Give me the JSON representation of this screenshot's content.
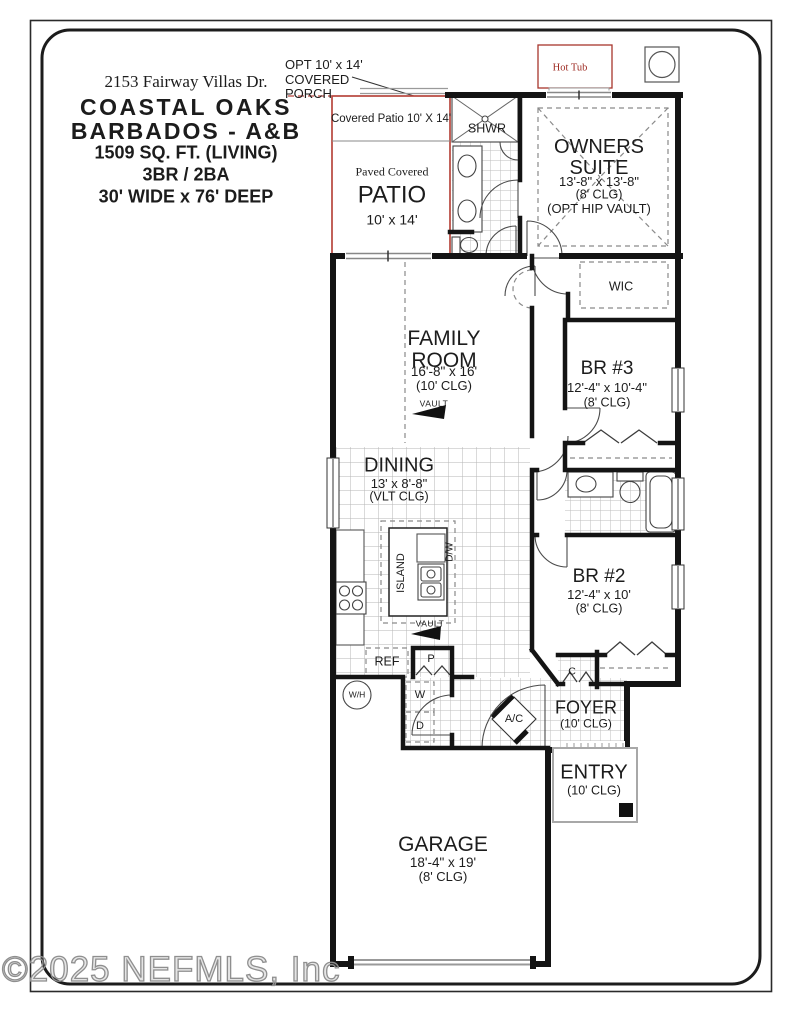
{
  "header": {
    "address": "2153 Fairway Villas Dr.",
    "plan_line1": "COASTAL OAKS",
    "plan_line2": "BARBADOS - A&B",
    "sqft": "1509 SQ. FT. (LIVING)",
    "beds_baths": "3BR  / 2BA",
    "size": "30' WIDE x 76' DEEP"
  },
  "annotations": {
    "opt_porch": "OPT 10' x 14'\nCOVERED\nPORCH",
    "hot_tub": "Hot Tub",
    "watermark": "©2025 NEFMLS, Inc"
  },
  "rooms": {
    "patio": {
      "covered_label": "Covered Patio 10' X 14'",
      "pretitle": "Paved Covered",
      "name": "PATIO",
      "dims": "10' x  14'"
    },
    "owners_suite": {
      "name": "OWNERS\nSUITE",
      "dims": "13'-8\" x  13'-8\"",
      "clg": "(8' CLG)",
      "opt": "(OPT HIP VAULT)"
    },
    "wic": {
      "name": "WIC"
    },
    "family": {
      "name": "FAMILY\nROOM",
      "dims": "16'-8\" x  16'",
      "clg": "(10' CLG)",
      "vault": "VAULT"
    },
    "br3": {
      "name": "BR #3",
      "dims": "12'-4\" x  10'-4\"",
      "clg": "(8' CLG)"
    },
    "dining": {
      "name": "DINING",
      "dims": "13' x  8'-8\"",
      "clg": "(VLT CLG)"
    },
    "br2": {
      "name": "BR #2",
      "dims": "12'-4\" x  10'",
      "clg": "(8' CLG)"
    },
    "foyer": {
      "name": "FOYER",
      "clg": "(10' CLG)"
    },
    "entry": {
      "name": "ENTRY",
      "clg": "(10' CLG)"
    },
    "garage": {
      "name": "GARAGE",
      "dims": "18'-4\" x  19'",
      "clg": "(8' CLG)"
    }
  },
  "fixtures": {
    "shower": "SHWR",
    "island": "ISLAND",
    "dishwasher": "D/W",
    "vault_kitchen": "VAULT",
    "refrigerator": "REF",
    "pantry": "P",
    "water_heater": "W/H",
    "washer": "W",
    "dryer": "D",
    "ac": "A/C",
    "closet": "C"
  },
  "colors": {
    "accent_red": "#b8463e",
    "dark_red": "#9e2b23",
    "wall": "#141414",
    "tile_line": "#bdbdbd",
    "watermark_gray": "#8f8f8f"
  }
}
